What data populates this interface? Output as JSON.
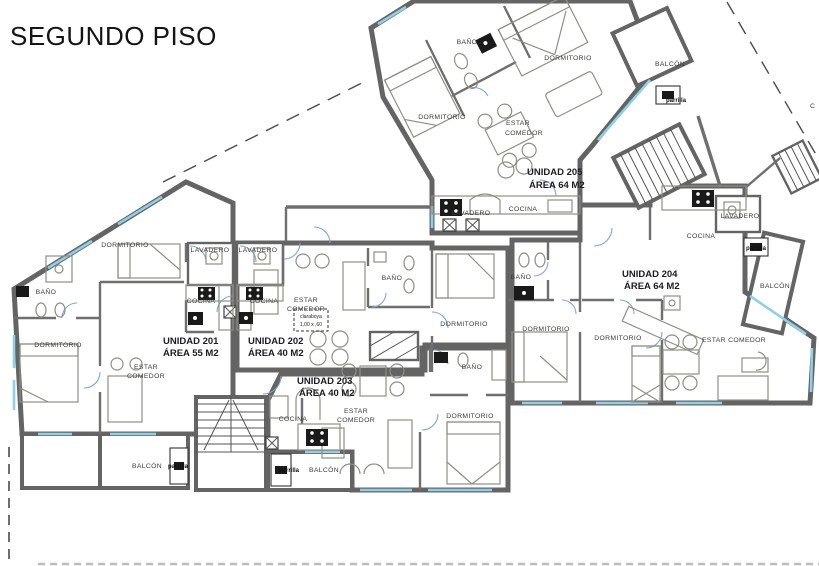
{
  "title": "SEGUNDO PISO",
  "plan": {
    "boundary_letter": "C",
    "colors": {
      "u201": "#f8f5ba",
      "u202": "#dcdbcb",
      "u203": "#f8cda6",
      "u204": "#d9efbc",
      "u205": "#cdeaf6",
      "wall": "#646464",
      "window": "#8fd0e8"
    },
    "labels": {
      "dormitorio": "DORMITORIO",
      "bano": "BAÑO",
      "cocina": "COCINA",
      "lavadero": "LAVADERO",
      "estar": "ESTAR",
      "comedor": "COMEDOR",
      "estar_comedor": "ESTAR COMEDOR",
      "balcon": "BALCÓN",
      "parrilla": "parrilla",
      "claraboya": "claraboya",
      "claraboya_size": "1,00 x ,60"
    },
    "units": [
      {
        "id": "201",
        "name": "UNIDAD 201",
        "area": "ÁREA 55 M2"
      },
      {
        "id": "202",
        "name": "UNIDAD 202",
        "area": "ÁREA 40 M2"
      },
      {
        "id": "203",
        "name": "UNIDAD 203",
        "area": "ÁREA 40 M2"
      },
      {
        "id": "204",
        "name": "UNIDAD 204",
        "area": "ÁREA 64 M2"
      },
      {
        "id": "205",
        "name": "UNIDAD 205",
        "area": "ÁREA 64 M2"
      }
    ]
  }
}
